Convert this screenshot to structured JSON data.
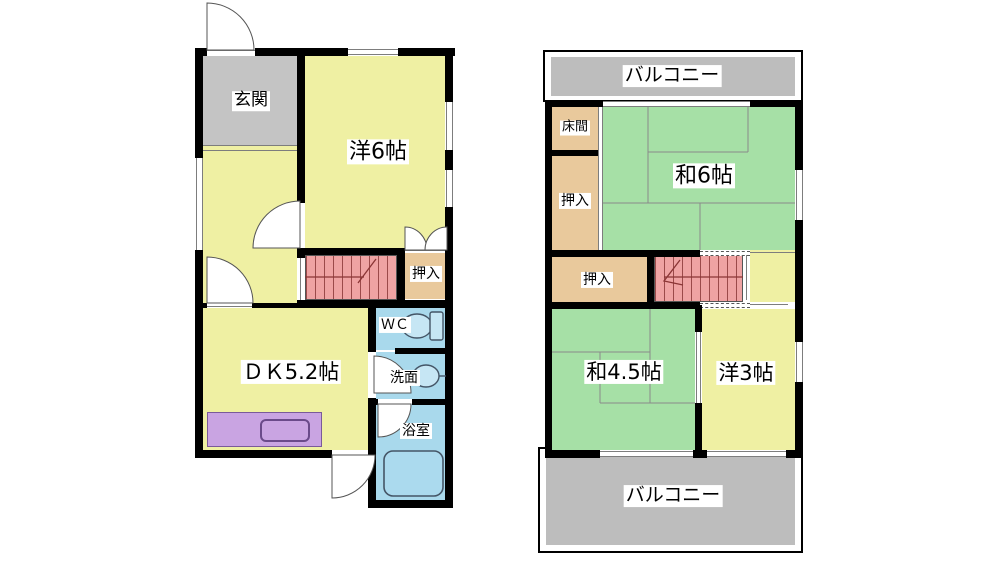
{
  "colors": {
    "yellow": "#eff0a3",
    "green": "#a6e0a6",
    "tan": "#e9c99c",
    "blue": "#a9d9ec",
    "purple": "#c9a4e2",
    "pink": "#efa3a3",
    "pinkLine": "#9b4a4a",
    "genkanGray": "#c4c4c4",
    "balconyGray": "#bdbdbd",
    "wall": "#000000",
    "line": "#7d7d7d"
  },
  "floor1": {
    "labels": {
      "genkan": "玄関",
      "western6": "洋6帖",
      "closet": "押入",
      "dk": "ＤＫ5.2帖",
      "wc": "ＷＣ",
      "washroom": "洗面",
      "bath": "浴室"
    }
  },
  "floor2": {
    "labels": {
      "balcony_top": "バルコニー",
      "tokonoma": "床間",
      "closet_upper": "押入",
      "japanese6": "和6帖",
      "closet_mid": "押入",
      "japanese45": "和4.5帖",
      "western3": "洋3帖",
      "balcony_bottom": "バルコニー"
    }
  },
  "icons": {
    "toilet": "toilet-icon",
    "sink": "washbasin-icon",
    "bathtub": "bathtub-icon",
    "kitchen_sink": "kitchen-sink-icon",
    "stair_arrow_f1": "stairs-direction-arrow",
    "stair_arrow_f2": "stairs-direction-arrow",
    "door_arcs": "door-swing-arc"
  }
}
